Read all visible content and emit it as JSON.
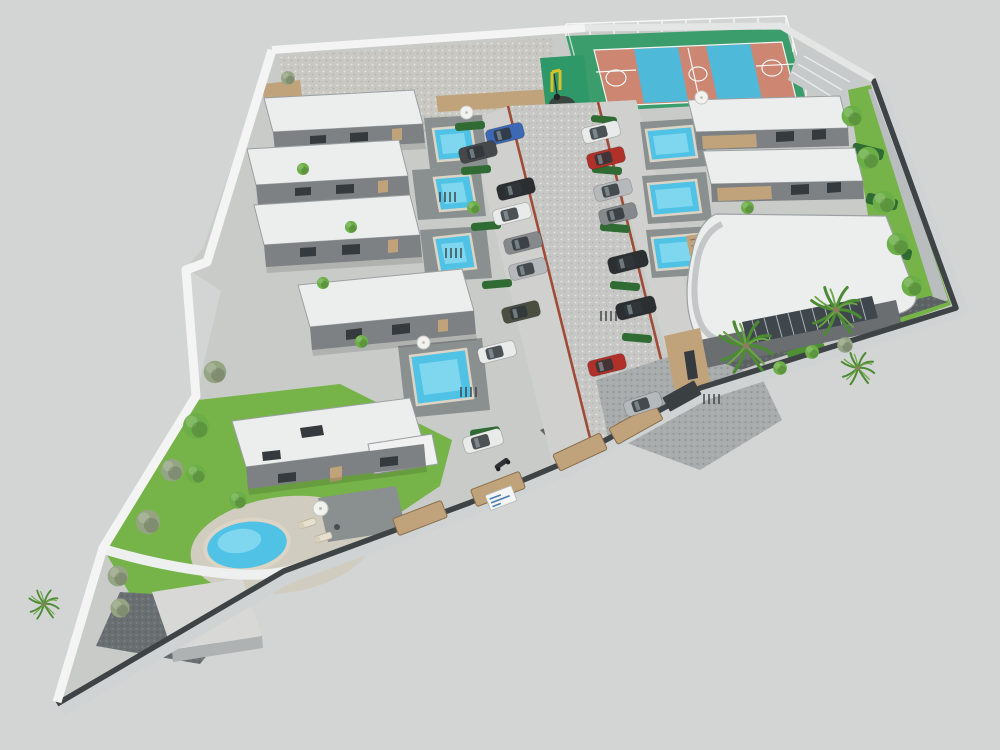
{
  "meta": {
    "type": "3d-architectural-site-plan-render",
    "description": "Aerial isometric 3D rendering of a gated residential compound: rows of white flat-roof villas with private blue pools on both sides of a central cobblestone street with parked cars, a fenced basketball court and playground at the top, a curved-roof clubhouse with palm trees, a detached villa with a round pool in the south-west garden, all enclosed by a white wall (north/west) and a dark wall with timber fence panels (east/south) on a plain light grey ground.",
    "background": "#d3d5d5"
  },
  "colors": {
    "background": "#d3d5d5",
    "ground": "#c9cbc8",
    "gravel": "#c9c8c3",
    "road": "#c7c8c5",
    "parking": "#d0d1ce",
    "plaza": "#a8acac",
    "gravel-dark": "#5d6264",
    "brick": "#a04b38",
    "wall-white": "#f3f4f3",
    "wall-dark": "#3e4346",
    "wall-outer": "#cfd3d4",
    "lawn": "#76b348",
    "lawn-dark": "#4f8f35",
    "hedge": "#2f6b33",
    "tree-olive": "#95a584",
    "tree-green": "#6cae47",
    "palm": "#6ca544",
    "palm-dark": "#4c8a33",
    "trunk": "#8b7c63",
    "court-green": "#3b9c6c",
    "court-clay": "#cd8672",
    "court-blue": "#4fb9d9",
    "line-white": "#f5f7f7",
    "pool-water": "#4fc2e6",
    "pool-light": "#93dff2",
    "pool-coping": "#dcd5c6",
    "patio-stone": "#8a8f8f",
    "roof-white": "#eceded",
    "roof-edge": "#9aa0a3",
    "facade": "#7d8183",
    "facade-dark": "#6a6e71",
    "window-dark": "#343a3e",
    "wood": "#c0a37b",
    "wood-dark": "#8a6f4f",
    "glass": "#3f474d",
    "car-white": "#e9eaea",
    "car-silver": "#b6b9bb",
    "car-gray": "#85898b",
    "car-black": "#2c2f32",
    "car-dark": "#44484b",
    "car-red": "#b03129",
    "car-blue": "#3c68b4",
    "car-olive": "#4a4f42",
    "sign-blue": "#4a7fb5"
  },
  "scene": {
    "site": {
      "shape": "irregular flag-shaped plot with pointed south-west tip",
      "perimeter_north_west": "white plastered wall",
      "perimeter_east_south": "dark grey wall with timber fence panels and outer light kerb"
    },
    "buildings": {
      "row_villas_west": 4,
      "row_villas_east": 2,
      "detached_villa_south_west": 1,
      "clubhouse": "curved wedge roof, glass facade, timber entrance, palm forecourt",
      "utility_building_south_tip": 1
    },
    "amenities": {
      "basketball_court": {
        "surfaces": [
          "clay",
          "blue"
        ],
        "fenced": true,
        "markings": "white"
      },
      "playground": {
        "floor": "green rubber",
        "equipment": "yellow frame"
      },
      "private_rectangular_pools": 7,
      "round_pool": 1,
      "sun_loungers": 2,
      "parasols": 4
    },
    "vehicles": {
      "cars_parked": 17,
      "car_colors_seen": [
        "white",
        "silver",
        "grey",
        "black",
        "dark-grey",
        "red",
        "blue",
        "olive"
      ],
      "motorcycle": 1,
      "bicycle_racks": 5
    },
    "vegetation": {
      "palm_trees": 4,
      "round_trees": 14,
      "hedge_blocks": 10,
      "lawn_strips": [
        "east boundary",
        "south-east garden",
        "south-west garden"
      ]
    },
    "entrance_sign": {
      "present": true,
      "text_legible": false
    }
  }
}
